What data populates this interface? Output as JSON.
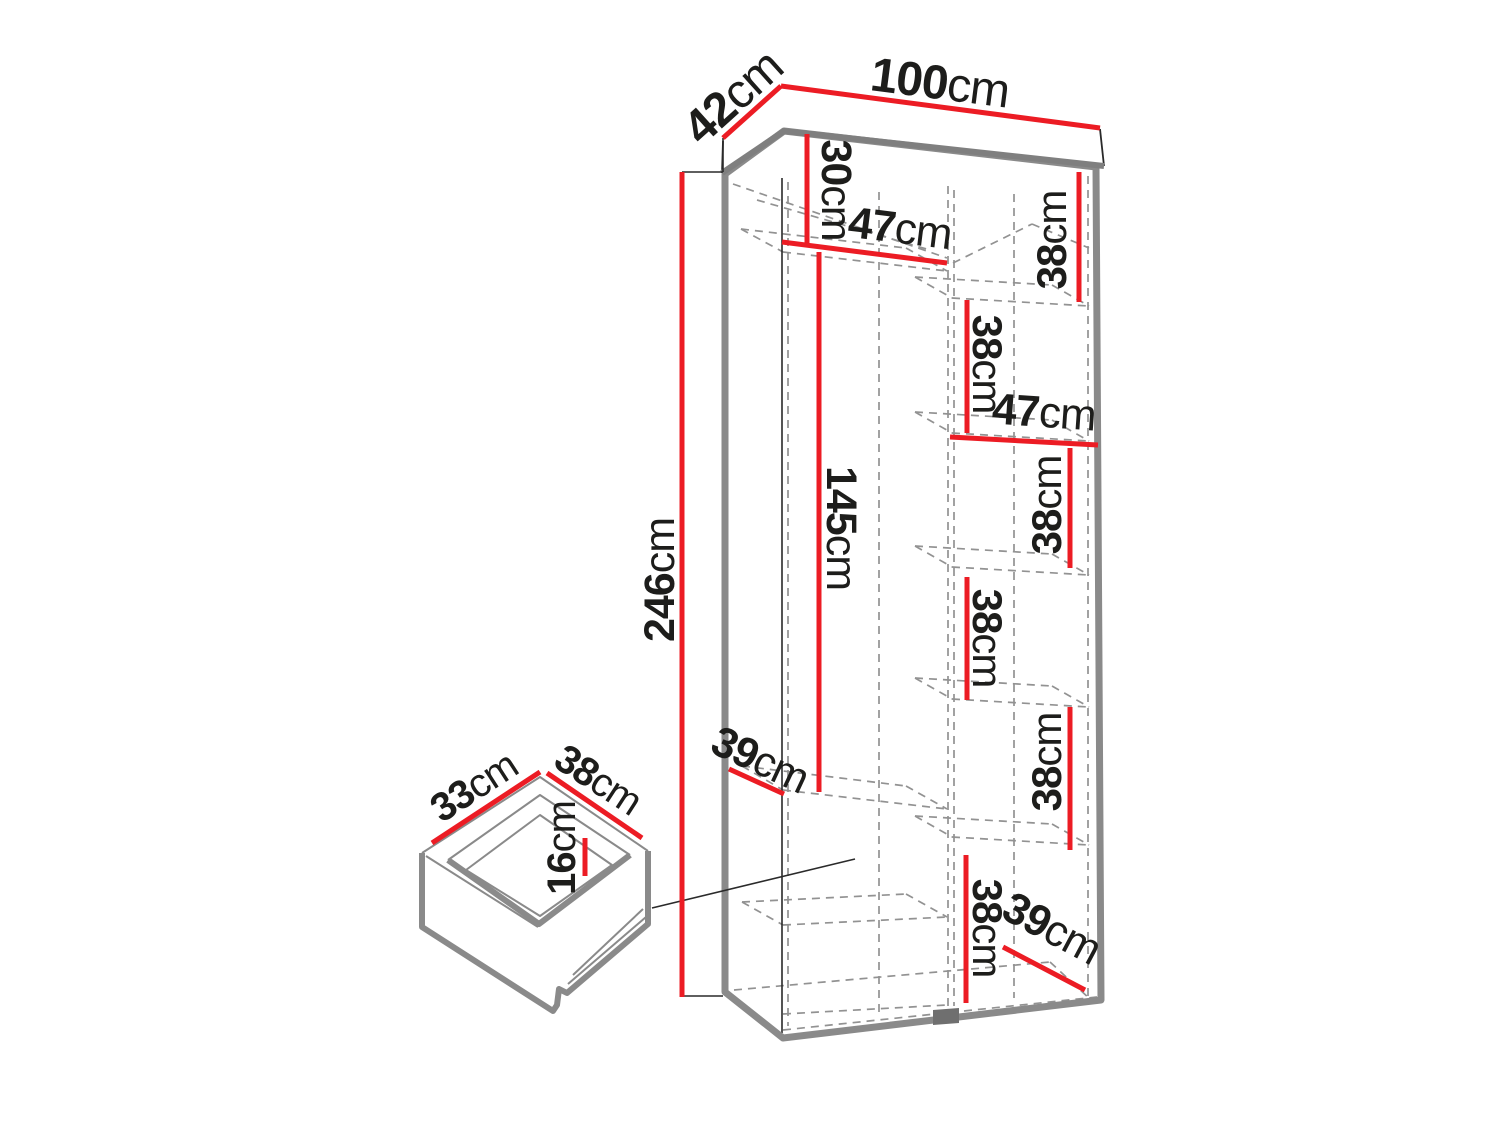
{
  "diagram": {
    "title": "wardrobe-dimension-diagram",
    "canvas": {
      "width": 1500,
      "height": 1125,
      "background": "#ffffff"
    },
    "colors": {
      "red": "#ec1c24",
      "thick_gray": "#8a8a8a",
      "slab_gray": "#7f7f7f",
      "dash_gray": "#929292",
      "thin_black": "#2a2a2a",
      "foot_gray": "#6f6f6f",
      "text": "#1d1d1b"
    },
    "dimensions_cm": {
      "overall": {
        "width": 100,
        "depth": 42,
        "height": 246
      },
      "left_column": {
        "top_section_height": 30,
        "shelf_width": 47,
        "hanging_height": 145,
        "shelf_depth": 39
      },
      "right_column": {
        "shelf_heights": [
          38,
          38,
          38,
          38,
          38,
          38
        ],
        "shelf_width": 47,
        "shelf_depth": 39
      },
      "drawer": {
        "width": 33,
        "depth": 38,
        "height": 16
      }
    },
    "carcass": {
      "outline": [
        [
          725,
          174
        ],
        [
          784,
          131
        ],
        [
          1096,
          167
        ],
        [
          1101,
          1000
        ],
        [
          783,
          1038
        ],
        [
          725,
          992
        ]
      ],
      "stroke_width": 7
    },
    "slab": {
      "fill": [
        [
          723,
          141
        ],
        [
          781,
          88
        ],
        [
          1100,
          129
        ],
        [
          1104,
          166
        ],
        [
          784,
          131
        ],
        [
          722,
          173
        ]
      ],
      "thin_edges": [
        [
          [
            1100,
            129
          ],
          [
            1104,
            166
          ]
        ],
        [
          [
            722,
            173
          ],
          [
            723,
            141
          ]
        ]
      ],
      "thick_v": [
        [
          1104,
          166
        ],
        [
          784,
          131
        ],
        [
          722,
          173
        ]
      ]
    },
    "partition_foot": [
      [
        933,
        1010
      ],
      [
        959,
        1008
      ],
      [
        959,
        1023
      ],
      [
        933,
        1025
      ]
    ],
    "dashed_lines": [
      [
        788,
        182,
        788,
        1026
      ],
      [
        879,
        192,
        879,
        1014
      ],
      [
        948,
        186,
        948,
        1006
      ],
      [
        954,
        190,
        954,
        1006
      ],
      [
        1014,
        194,
        1014,
        998
      ],
      [
        1088,
        176,
        1088,
        998
      ],
      [
        733,
        184,
        947,
        258
      ],
      [
        757,
        200,
        930,
        250
      ],
      [
        953,
        263,
        1032,
        224
      ],
      [
        1032,
        224,
        1089,
        248
      ],
      [
        783,
        252,
        947,
        271
      ],
      [
        741,
        229,
        906,
        248
      ],
      [
        741,
        229,
        783,
        252
      ],
      [
        906,
        248,
        947,
        271
      ],
      [
        952,
        298,
        1089,
        306
      ],
      [
        915,
        277,
        1052,
        285
      ],
      [
        915,
        277,
        952,
        298
      ],
      [
        1052,
        285,
        1089,
        306
      ],
      [
        952,
        433,
        1089,
        441
      ],
      [
        915,
        412,
        1052,
        420
      ],
      [
        915,
        412,
        952,
        433
      ],
      [
        1052,
        420,
        1089,
        441
      ],
      [
        952,
        567,
        1089,
        575
      ],
      [
        915,
        546,
        1052,
        554
      ],
      [
        915,
        546,
        952,
        567
      ],
      [
        1052,
        554,
        1089,
        575
      ],
      [
        952,
        699,
        1089,
        707
      ],
      [
        915,
        678,
        1052,
        686
      ],
      [
        915,
        678,
        952,
        699
      ],
      [
        1052,
        686,
        1089,
        707
      ],
      [
        952,
        837,
        1089,
        845
      ],
      [
        915,
        816,
        1052,
        824
      ],
      [
        915,
        816,
        952,
        837
      ],
      [
        1052,
        824,
        1089,
        845
      ],
      [
        783,
        790,
        947,
        809
      ],
      [
        742,
        766,
        906,
        786
      ],
      [
        742,
        766,
        783,
        790
      ],
      [
        906,
        786,
        947,
        809
      ],
      [
        783,
        925,
        947,
        917
      ],
      [
        742,
        902,
        906,
        894
      ],
      [
        742,
        902,
        783,
        925
      ],
      [
        906,
        894,
        947,
        917
      ],
      [
        783,
        1030,
        1097,
        997
      ],
      [
        734,
        990,
        1050,
        962
      ],
      [
        1050,
        962,
        1090,
        999
      ],
      [
        783,
        1014,
        947,
        1005
      ]
    ],
    "solid_thin_lines": [
      [
        782,
        178,
        782,
        1033
      ]
    ],
    "tick_lines": [
      [
        682,
        172,
        723,
        172
      ],
      [
        682,
        996,
        723,
        996
      ],
      [
        723,
        138,
        723,
        172
      ]
    ],
    "leader_lines": [
      [
        652,
        908,
        855,
        859
      ]
    ],
    "red_lines": [
      {
        "name": "dim-42",
        "pts": [
          723,
          138,
          781,
          86
        ]
      },
      {
        "name": "dim-100",
        "pts": [
          781,
          86,
          1100,
          128
        ]
      },
      {
        "name": "dim-246",
        "pts": [
          682,
          172,
          682,
          997
        ]
      },
      {
        "name": "dim-30",
        "pts": [
          807,
          134,
          807,
          243
        ]
      },
      {
        "name": "dim-47-left",
        "pts": [
          782,
          242,
          947,
          263
        ]
      },
      {
        "name": "dim-145",
        "pts": [
          819,
          252,
          819,
          792
        ]
      },
      {
        "name": "dim-39-left",
        "pts": [
          729,
          769,
          784,
          794
        ]
      },
      {
        "name": "dim-38-r1",
        "pts": [
          1079,
          172,
          1079,
          302
        ]
      },
      {
        "name": "dim-38-r2",
        "pts": [
          967,
          300,
          967,
          433
        ]
      },
      {
        "name": "dim-47-right",
        "pts": [
          950,
          437,
          1098,
          445
        ]
      },
      {
        "name": "dim-38-r3",
        "pts": [
          1070,
          448,
          1070,
          568
        ]
      },
      {
        "name": "dim-38-r4",
        "pts": [
          967,
          577,
          967,
          700
        ]
      },
      {
        "name": "dim-38-r5",
        "pts": [
          1070,
          707,
          1070,
          850
        ]
      },
      {
        "name": "dim-38-r6",
        "pts": [
          966,
          855,
          966,
          1003
        ]
      },
      {
        "name": "dim-39-right",
        "pts": [
          1003,
          947,
          1085,
          990
        ]
      },
      {
        "name": "dim-33-drawer",
        "pts": [
          432,
          843,
          540,
          772
        ]
      },
      {
        "name": "dim-38-drawer",
        "pts": [
          547,
          773,
          642,
          838
        ]
      },
      {
        "name": "dim-16-drawer",
        "pts": [
          585,
          838,
          585,
          876
        ]
      }
    ],
    "labels": [
      {
        "value": "42",
        "unit": "cm",
        "x": 733,
        "y": 97,
        "rot": -42,
        "size": 48
      },
      {
        "value": "100",
        "unit": "cm",
        "x": 940,
        "y": 83,
        "rot": 7.3,
        "size": 48
      },
      {
        "value": "246",
        "unit": "cm",
        "x": 660,
        "y": 580,
        "rot": -90,
        "size": 43
      },
      {
        "value": "30",
        "unit": "cm",
        "x": 836,
        "y": 190,
        "rot": 90,
        "size": 43
      },
      {
        "value": "47",
        "unit": "cm",
        "x": 900,
        "y": 228,
        "rot": 7,
        "size": 44
      },
      {
        "value": "145",
        "unit": "cm",
        "x": 841,
        "y": 528,
        "rot": 90,
        "size": 43
      },
      {
        "value": "39",
        "unit": "cm",
        "x": 760,
        "y": 760,
        "rot": 25,
        "size": 43
      },
      {
        "value": "38",
        "unit": "cm",
        "x": 1051,
        "y": 240,
        "rot": -90,
        "size": 42
      },
      {
        "value": "38",
        "unit": "cm",
        "x": 988,
        "y": 364,
        "rot": 90,
        "size": 42
      },
      {
        "value": "47",
        "unit": "cm",
        "x": 1044,
        "y": 412,
        "rot": 4,
        "size": 44
      },
      {
        "value": "38",
        "unit": "cm",
        "x": 1046,
        "y": 505,
        "rot": -90,
        "size": 42
      },
      {
        "value": "38",
        "unit": "cm",
        "x": 988,
        "y": 638,
        "rot": 90,
        "size": 42
      },
      {
        "value": "38",
        "unit": "cm",
        "x": 1046,
        "y": 762,
        "rot": -90,
        "size": 42
      },
      {
        "value": "38",
        "unit": "cm",
        "x": 988,
        "y": 928,
        "rot": 90,
        "size": 42
      },
      {
        "value": "39",
        "unit": "cm",
        "x": 1052,
        "y": 928,
        "rot": 28,
        "size": 44
      },
      {
        "value": "33",
        "unit": "cm",
        "x": 474,
        "y": 787,
        "rot": -33,
        "size": 40
      },
      {
        "value": "38",
        "unit": "cm",
        "x": 598,
        "y": 780,
        "rot": 33,
        "size": 40
      },
      {
        "value": "16",
        "unit": "cm",
        "x": 562,
        "y": 848,
        "rot": -90,
        "size": 40
      }
    ],
    "drawer": {
      "silhouette": [
        [
          422,
          853
        ],
        [
          540,
          777
        ],
        [
          648,
          849
        ],
        [
          648,
          924
        ],
        [
          568,
          993
        ],
        [
          558,
          1007
        ],
        [
          553,
          1011
        ],
        [
          422,
          927
        ]
      ],
      "thick_paths": [
        "M422,853 L422,927 L553,1011 L557,1005 L559,989 L567,993 L648,924 L648,851",
        "M448,860 L539,924 L630,855"
      ],
      "thin_paths": [
        "M422,853 L540,777 L648,851",
        "M448,860 L540,795 L630,855",
        "M426,856 L538,927",
        "M466,870 L540,815 L612,865 L540,916 Z",
        "M568,984 L646,917",
        "M573,975 L643,909"
      ]
    }
  }
}
